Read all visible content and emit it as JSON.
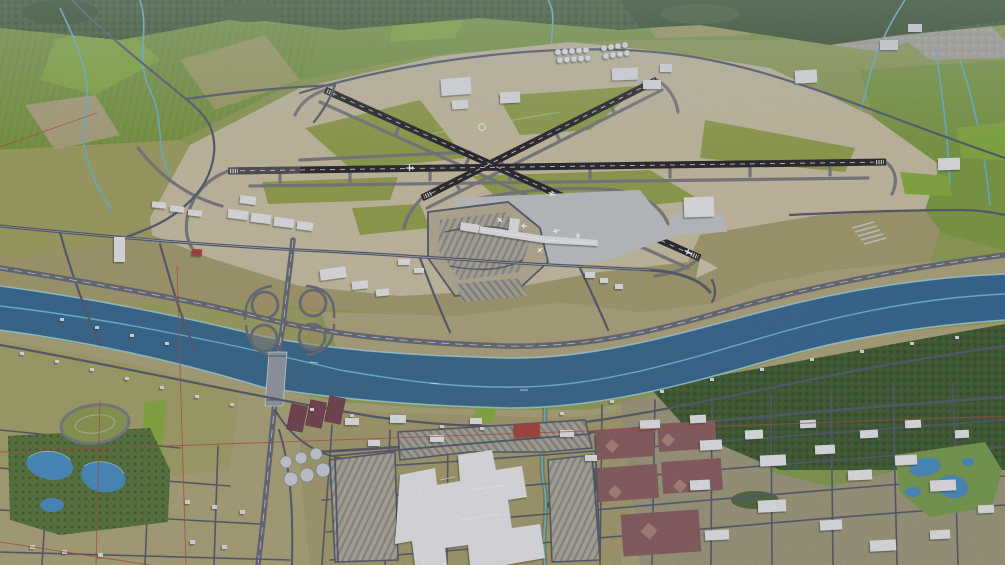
{
  "scene": {
    "type": "3d-aerial-oblique-render",
    "description": "3D aerial render of an international airport with three crossing runways beside a wide river; freeway cloverleaf interchange and bridge; industrial city grid and shopping mall south of the river; farm fields and forest belt to the north",
    "landmarks": [
      "forest-belt",
      "farm-fields",
      "airport-apron",
      "runway-east-west",
      "runway-nw-se",
      "runway-ne-sw",
      "taxiway-network",
      "terminal-building",
      "terminal-apron",
      "parking-lots",
      "cargo-buildings",
      "fuel-tank-farm",
      "hangars",
      "helipad",
      "cloverleaf-interchange",
      "river",
      "river-bridge",
      "freeway",
      "city-street-grid",
      "shopping-mall",
      "warehouse-district",
      "sports-fields",
      "water-park-ponds",
      "treatment-plant",
      "west-park-ponds",
      "race-track-oval",
      "streams",
      "section-lines"
    ],
    "colors": {
      "field_base": "#98a55e",
      "field_green": "#83a24c",
      "field_bright": "#8db449",
      "field_olive": "#a8a76b",
      "field_tan": "#b5ab85",
      "dirt": "#aba276",
      "forest": "#47633b",
      "forest_dark": "#3a5431",
      "apron_tan": "#cfc5ab",
      "apron_gray": "#c6c9cf",
      "runway": "#302f33",
      "taxiway": "#7d7f87",
      "road": "#5c6273",
      "freeway": "#6d717d",
      "road_white": "#eceef1",
      "river": "#4079a3",
      "water_light": "#7cc6e4",
      "bank_light": "#a9d8e8",
      "stream": "#6fbcdc",
      "building": "#e9ebef",
      "red_roof": "#b04a42",
      "maroon_field": "#8f6468",
      "maroon_light": "#b08a80",
      "pond_blue": "#4f93c8",
      "treatment_pond": "#7c4a58",
      "red_line": "#b5524d",
      "grass_infield": "#9aa854",
      "park_green": "#5f7d45",
      "gravel": "#b2ada3"
    }
  }
}
